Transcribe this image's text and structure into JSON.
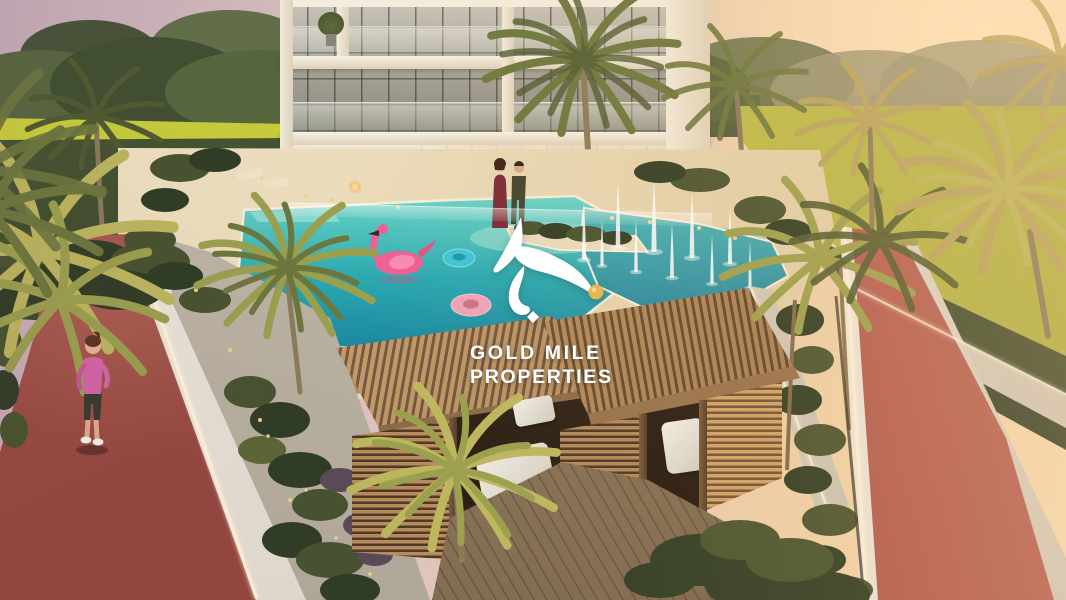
{
  "watermark": {
    "line1": "GOLD MILE",
    "line2": "PROPERTIES",
    "logo_mark": "calligraphy-swoosh-icon",
    "logo_accent": "gold-dot"
  },
  "palette": {
    "skyLeft": "#c4abb8",
    "skyMid": "#dcc3bd",
    "skyRight": "#efd2a8",
    "sunGlow": "#ffe7bf",
    "treeDark": "#3f4e30",
    "treeMid": "#55663e",
    "treeHaze": "#9b9878",
    "lawnBright": "#c9cf3c",
    "lawnRight": "#c3c14e",
    "hedge": "#35432a",
    "buildingWhite": "#f4edde",
    "glassTop": "#c9c4ba",
    "interiorHot": "#e08a40",
    "deckCream": "#e7d7b4",
    "deckWood": "#b98a58",
    "poolLight": "#6fd6c8",
    "poolMid": "#2aa9b0",
    "poolDeep": "#1a86a0",
    "coping": "#f6eed9",
    "trackRed": "#a5524a",
    "wallWhite": "#f2eee5",
    "led": "#fff3da",
    "pathGrey": "#c6beae",
    "woodLit": "#c79a64",
    "woodShade": "#5d4430",
    "cushion": "#f2f0e8",
    "deckPlank": "#a08a68",
    "shrub1": "#2e3c25",
    "shrub2": "#46532f",
    "shrub3": "#5a6637",
    "shrubPurple": "#594a58",
    "palmDark": "#4e5a30",
    "palmMid": "#6b773d",
    "palmLight": "#9aa04e",
    "palmYellow": "#bcb75e",
    "palmGold": "#b6a45e",
    "trunk": "#8a7a5a",
    "flamingo": "#ee5f96",
    "flamingoDeep": "#d84b82",
    "floatBlue": "#3ec3d6",
    "floatPink": "#eea2b8",
    "skin": "#e2ae92",
    "dressRed": "#7b2b36",
    "manDark": "#42432e",
    "joggerPink": "#cf62a0",
    "joggerCapri": "#3a3a31",
    "hairAuburn": "#5c3527",
    "logoWhite": "#ffffff",
    "logoGold": "#e4b84f",
    "fountainWhite": "#ffffff"
  }
}
